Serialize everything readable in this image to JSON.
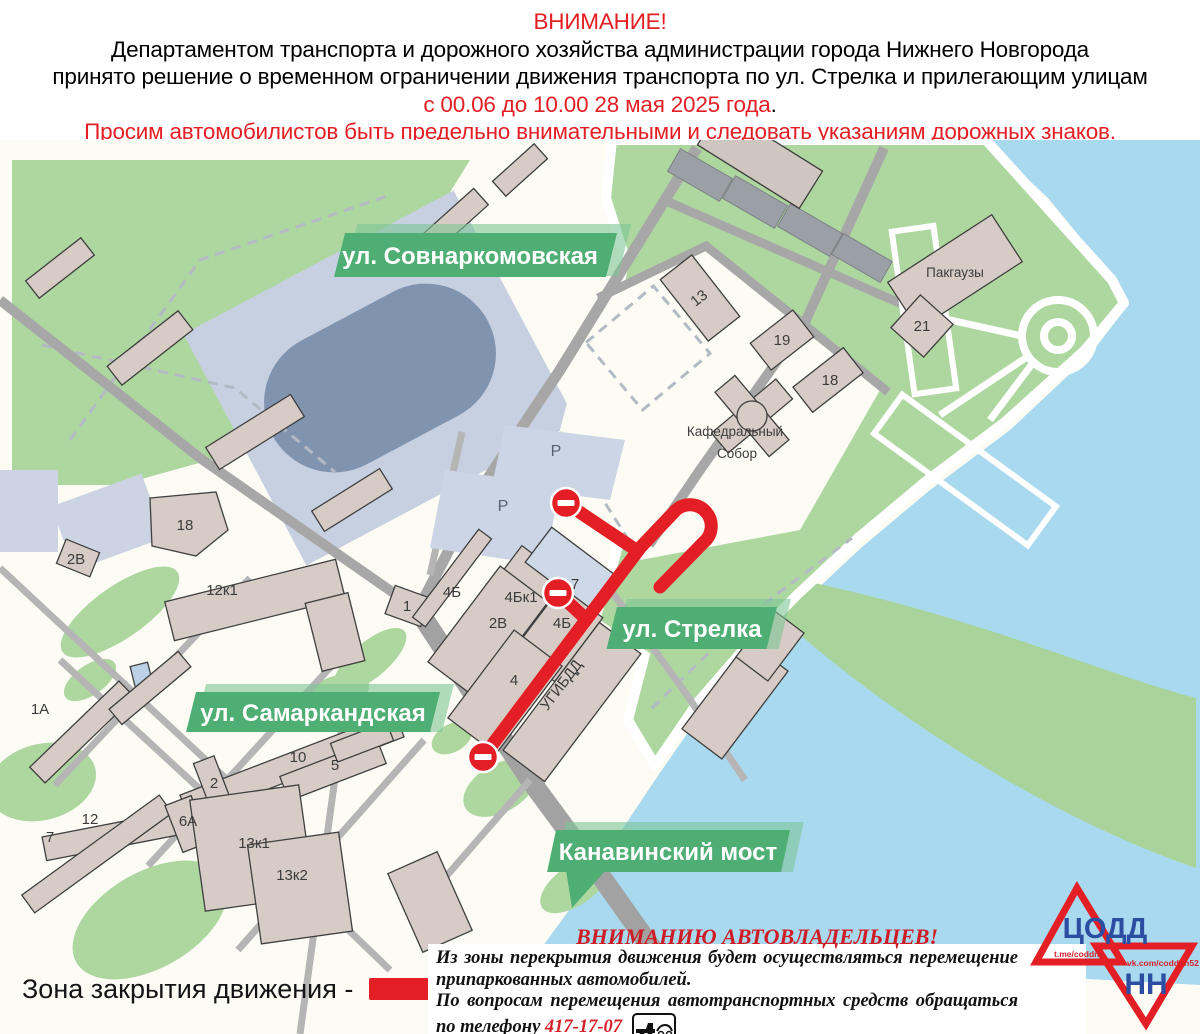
{
  "header": {
    "attention": "ВНИМАНИЕ!",
    "line1": "Департаментом транспорта и дорожного хозяйства администрации города Нижнего Новгорода",
    "line2": "принято решение о временном ограничении движения транспорта по ул. Стрелка и прилегающим улицам",
    "dates": "с 00.06 до 10.00 28 мая 2025 года",
    "dates_period": ".",
    "warning": "Просим автомобилистов быть предельно внимательными и следовать указаниям дорожных знаков."
  },
  "map": {
    "streets": {
      "sovnarkomovskaya": "ул. Совнаркомовская",
      "strelka": "ул. Стрелка",
      "samarkandskaya": "ул. Самаркандская",
      "kanavinsky": "Канавинский мост"
    },
    "places": {
      "pakgauzy": "Пакгаузы",
      "cathedral_line1": "Кафедральный",
      "cathedral_line2": "Собор",
      "ugibdd": "УГИБДД",
      "parking": "Р"
    },
    "buildings": {
      "b13": "13",
      "b19": "19",
      "b18_right": "18",
      "b21": "21",
      "b18_left": "18",
      "b2v_left": "2В",
      "b12k1": "12к1",
      "b1": "1",
      "b4b": "4Б",
      "b4bk1": "4Бк1",
      "b2v": "2В",
      "b4b2": "4Б",
      "b7": "7",
      "b4": "4",
      "b1a": "1А",
      "b10": "10",
      "b2": "2",
      "b5": "5",
      "b12": "12",
      "b6a": "6А",
      "b7_left": "7",
      "b13k1": "13к1",
      "b13k2": "13к2"
    }
  },
  "legend": {
    "label": "Зона закрытия движения -"
  },
  "notice": {
    "title": "ВНИМАНИЮ АВТОВЛАДЕЛЬЦЕВ!",
    "p1": "Из зоны перекрытия движения будет осуществляться перемещение припаркованных автомобилей.",
    "p2": "По вопросам перемещения автотранспортных средств обращаться по телефону",
    "phone": "417-17-07"
  },
  "logo": {
    "org": "ЦОДД",
    "city": "НН",
    "telegram": "t.me/coddnn",
    "vk": "vk.com/coddnn52"
  },
  "colors": {
    "alert_red": "#e31e24",
    "banner_green": "#4fae73",
    "water_blue": "#a9d9ef",
    "park_green": "#aed7a0",
    "road_gray": "#a7a7a7",
    "building_beige": "#d6ccc5",
    "stadium_blue": "#c7d0e0",
    "logo_blue": "#2b4ea2"
  }
}
